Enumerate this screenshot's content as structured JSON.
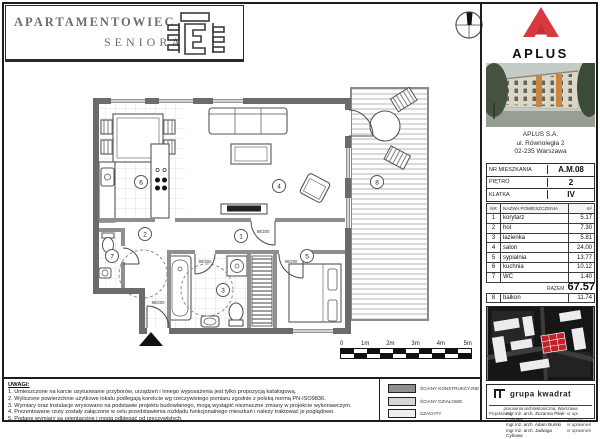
{
  "header": {
    "title_line1": "APARTAMENTOWIEC",
    "title_line2": "SENIORA"
  },
  "plan": {
    "room_markers": [
      "1",
      "2",
      "3",
      "4",
      "5",
      "6",
      "7",
      "8"
    ],
    "door_labels": [
      "90/200",
      "90/200",
      "90/200",
      "90/200"
    ],
    "structural_wall_color": "#6b6b6b",
    "partition_wall_color": "#8f8f8f"
  },
  "scalebar": {
    "labels": [
      "0",
      "1m",
      "2m",
      "3m",
      "4m",
      "5m"
    ]
  },
  "notes": {
    "heading": "UWAGI:",
    "items": [
      "1. Umieszczone na karcie usytuowanie przyborów, urządzeń i innego wyposażenia jest tylko propozycją katalogową.",
      "2. Wyliczone powierzchnie użytkowe lokalu podlegają korekcie wg rzeczywistego pomiaru zgodnie z polską normą PN-ISO9836.",
      "3. Wymiary oraz instalacje wrysowano na podstawie projektu budowlanego, mogą wystąpić nieznaczne zmiany w projekcie wykonawczym.",
      "4. Prezentowane rzuty zostały załączone w celu przedstawienia rozkładu funkcjonalnego mieszkań i należy traktować je poglądowo.",
      "5. Podane wymiary są orientacyjne i mogą odbiegać od rzeczywistych."
    ]
  },
  "legend": {
    "items": [
      {
        "label": "ŚCIANY KONSTRUKCYJNE",
        "color": "#8f8f8f"
      },
      {
        "label": "ŚCIANY DZIAŁOWE",
        "color": "#d6d6d6"
      },
      {
        "label": "SZACHTY",
        "color": "#efefef"
      }
    ]
  },
  "sidebar": {
    "brand": {
      "name": "APLUS",
      "accent": "#d8393f",
      "accent_dark": "#c13237"
    },
    "address": {
      "line1": "APLUS S.A.",
      "line2": "ul. Równoległa 2",
      "line3": "02-235  Warszawa"
    },
    "unit": {
      "rows": [
        {
          "label": "NR MIESZKANIA",
          "value": "A.M.08"
        },
        {
          "label": "PIĘTRO",
          "value": "2"
        },
        {
          "label": "KLATKA",
          "value": "IV"
        }
      ]
    },
    "rooms_table": {
      "col_nr": "NR",
      "col_name": "NAZWA POMIESZCZENIA",
      "col_area": "m²",
      "rows": [
        {
          "nr": "1",
          "name": "korytarz",
          "area": "5.17"
        },
        {
          "nr": "2",
          "name": "hol",
          "area": "7.30"
        },
        {
          "nr": "3",
          "name": "łazienka",
          "area": "5.81"
        },
        {
          "nr": "4",
          "name": "salon",
          "area": "24.00"
        },
        {
          "nr": "5",
          "name": "sypialnia",
          "area": "13.77"
        },
        {
          "nr": "6",
          "name": "kuchnia",
          "area": "10.12"
        },
        {
          "nr": "7",
          "name": "WC",
          "area": "1.40"
        }
      ],
      "total_label": "RAZEM",
      "total_value": "67.57",
      "balcony_row": {
        "nr": "8",
        "name": "balkon",
        "area": "11.74"
      }
    },
    "signature": {
      "studio": "grupa kwadrat",
      "studio_sub": "pracownia architektoniczna, Warszawa",
      "designed_label": "Projektował",
      "designers": [
        {
          "name": "mgr inż. arch. Zuzanna Piłak-Cybowa",
          "upr": "nr upr. 384/010"
        },
        {
          "name": "mgr inż. arch. Adam Burski",
          "upr": "nr uprawnień"
        },
        {
          "name": "mgr inż. arch. Jadwiga Cybowa",
          "upr": "nr uprawnień"
        }
      ]
    }
  }
}
